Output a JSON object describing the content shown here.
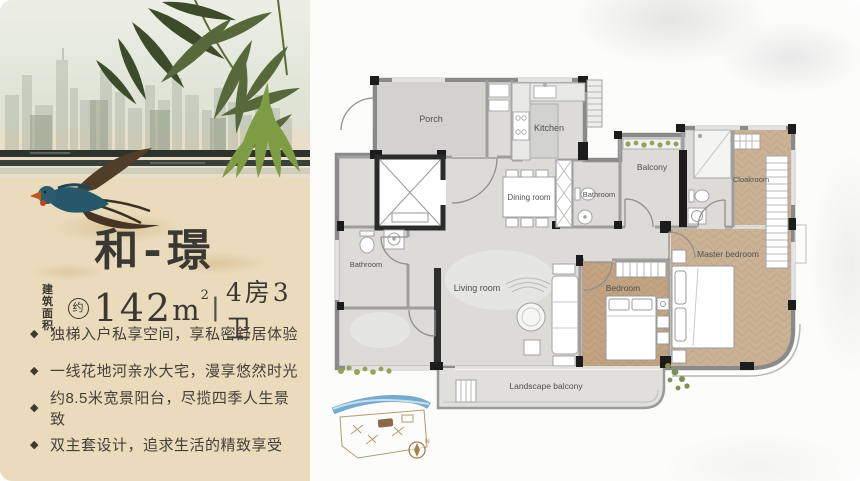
{
  "left_panel": {
    "title": "和-璟",
    "spec": {
      "area_prefix_top": "建筑",
      "area_prefix_bottom": "面积",
      "approx_badge": "约",
      "area_value": "142",
      "area_unit_base": "m",
      "area_unit_sup": "2",
      "divider": "|",
      "layout_text": "4房3卫"
    },
    "bullet_marker": "◆",
    "bullets": [
      "独梯入户私享空间，享私密舒居体验",
      "一线花地河亲水大宅，漫享悠然时光",
      "约8.5米宽景阳台，尽揽四季人生景致",
      "双主套设计，追求生活的精致享受"
    ]
  },
  "floorplan": {
    "room_labels": {
      "porch": "Porch",
      "kitchen": "Kitchen",
      "balcony": "Balcony",
      "bathroom_middle": "Bathroom",
      "cloakroom": "Cloakroom",
      "dining_room": "Dining room",
      "bathroom_left": "Bathroom",
      "living_room": "Living room",
      "bedroom": "Bedroom",
      "master_bedroom": "Master bedroom",
      "landscape_balcony": "Landscape balcony"
    },
    "compass": {
      "north_label": "N"
    }
  },
  "colors": {
    "panel_beige": "#e9dbbc",
    "title_ink": "#3b3833",
    "bamboo_dark": "#3e4b2a",
    "bamboo_bright": "#7d9c44",
    "bird_teal": "#27586a",
    "floor_grey": "#dcdbd8",
    "floor_wood": "#c2a482",
    "wall_grey": "#8a8a8a",
    "wall_black": "#1c1c1c",
    "site_river_blue": "#5e9cc4",
    "compass_brown": "#a5814f"
  }
}
